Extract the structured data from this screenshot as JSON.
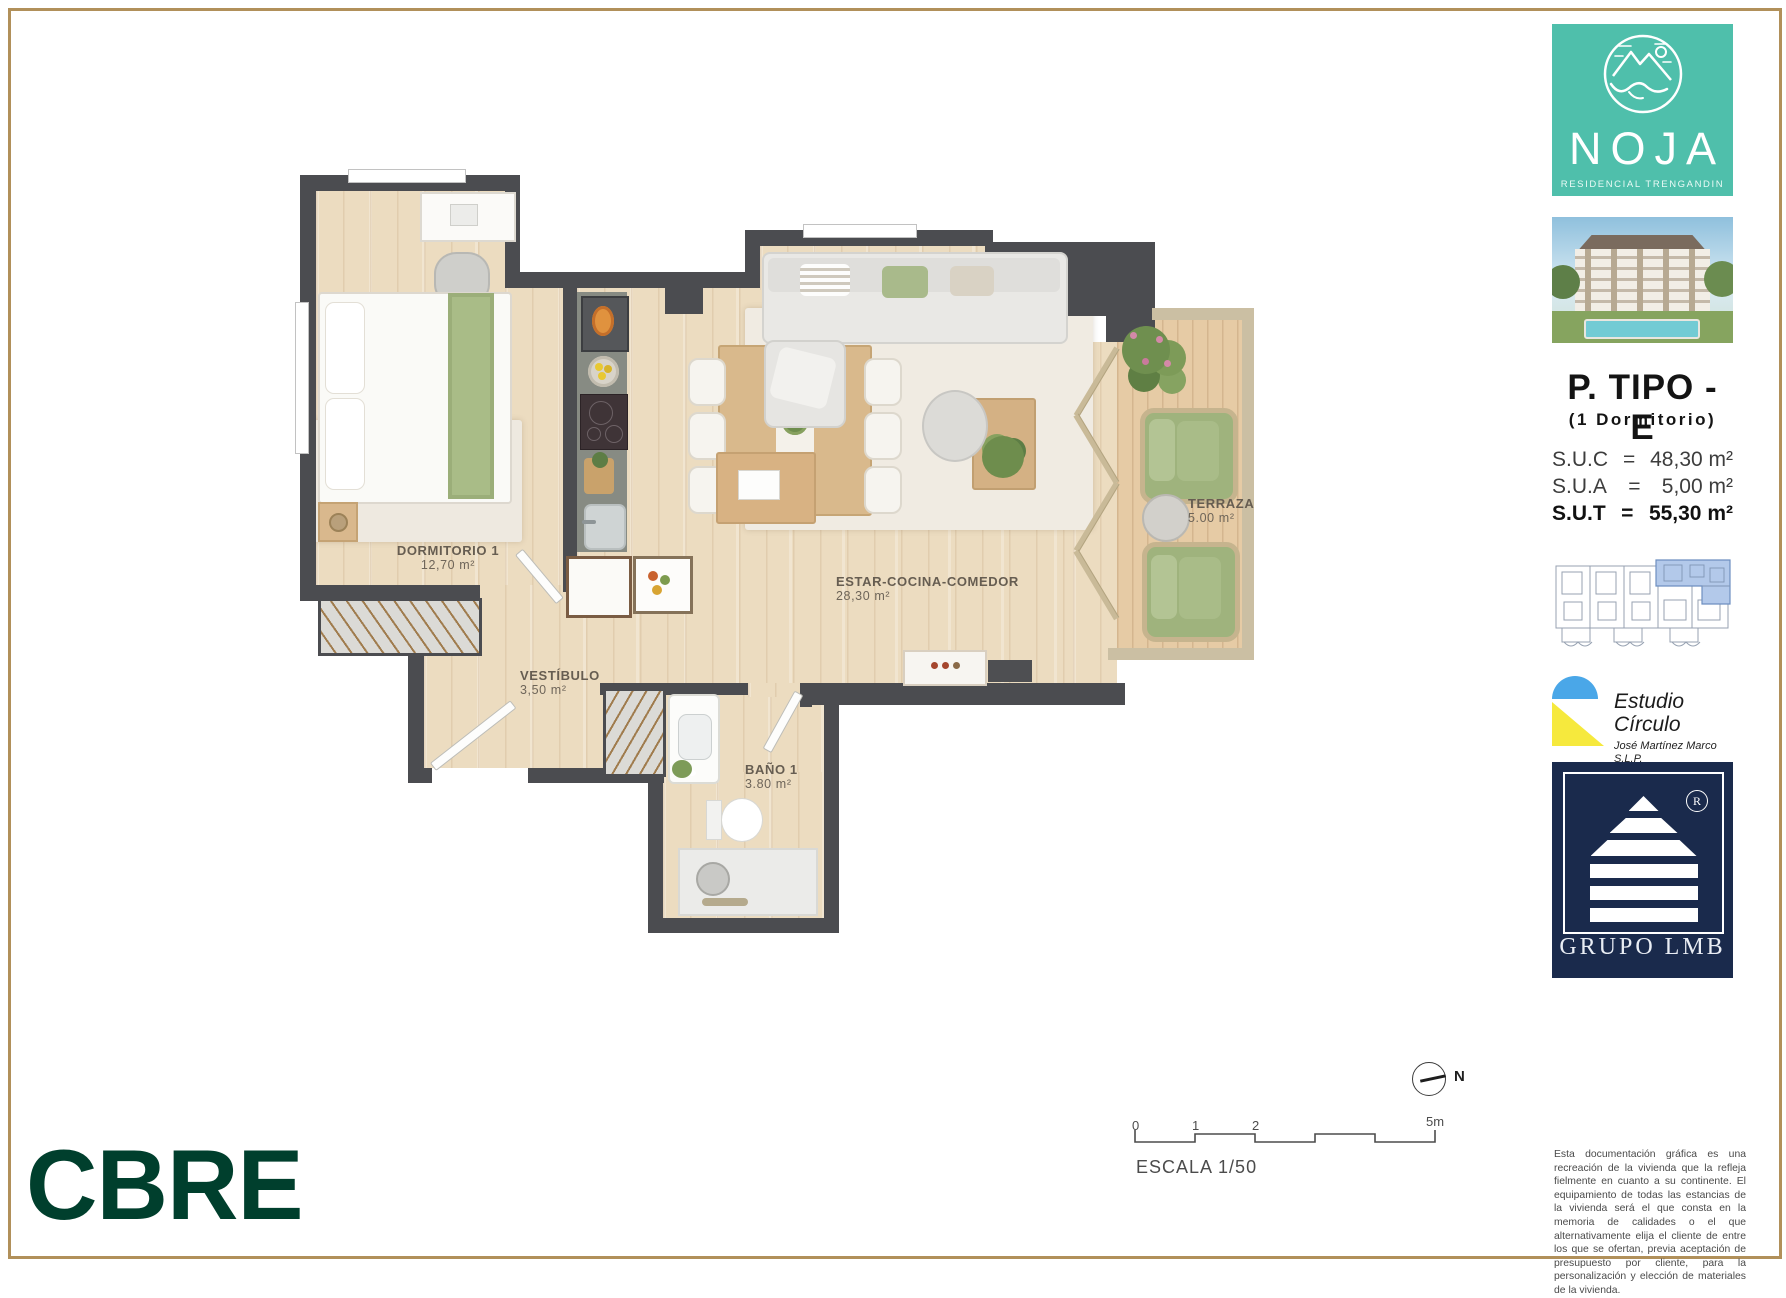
{
  "frame": {
    "border_color": "#b1905a"
  },
  "sidebar": {
    "noja": {
      "name": "NOJA",
      "subtitle": "RESIDENCIAL TRENGANDIN",
      "bg": "#4fbfab"
    },
    "plan": {
      "title": "P. TIPO - E",
      "subtitle": "(1 Dormitorio)"
    },
    "areas": [
      {
        "label": "S.U.C",
        "eq": "=",
        "value": "48,30 m²"
      },
      {
        "label": "S.U.A",
        "eq": "=",
        "value": "5,00 m²"
      },
      {
        "label": "S.U.T",
        "eq": "=",
        "value": "55,30 m²"
      }
    ],
    "estudio": {
      "name": "Estudio Círculo",
      "line2": "José Martínez Marco S.L.P.",
      "line3": "Arquitecto",
      "blue": "#4aa7e8",
      "yellow": "#f6e93d"
    },
    "grupo": {
      "name": "GRUPO LMB",
      "registered": "R",
      "bg": "#1a2a4c"
    }
  },
  "floorplan": {
    "rooms": [
      {
        "name": "DORMITORIO 1",
        "area": "12,70 m²"
      },
      {
        "name": "VESTÍBULO",
        "area": "3,50 m²"
      },
      {
        "name": "BAÑO 1",
        "area": "3.80 m²"
      },
      {
        "name": "ESTAR-COCINA-COMEDOR",
        "area": "28,30 m²"
      },
      {
        "name": "TERRAZA",
        "area": "5.00 m²"
      }
    ]
  },
  "footer": {
    "cbre": "CBRE",
    "cbre_color": "#003f2d",
    "scale": {
      "ticks": [
        "0",
        "1",
        "2"
      ],
      "end": "5m",
      "caption": "ESCALA 1/50"
    },
    "north": "N",
    "disclaimer": "Esta documentación gráfica es una recreación de la vivienda que la refleja fielmente en cuanto a su continente. El equipamiento de todas las estancias de la vivienda será el que consta en la memoria de calidades o el que alternativamente elija el cliente de entre los que se ofertan, previa aceptación de presupuesto por cliente, para la personalización y elección de materiales de la vivienda."
  }
}
